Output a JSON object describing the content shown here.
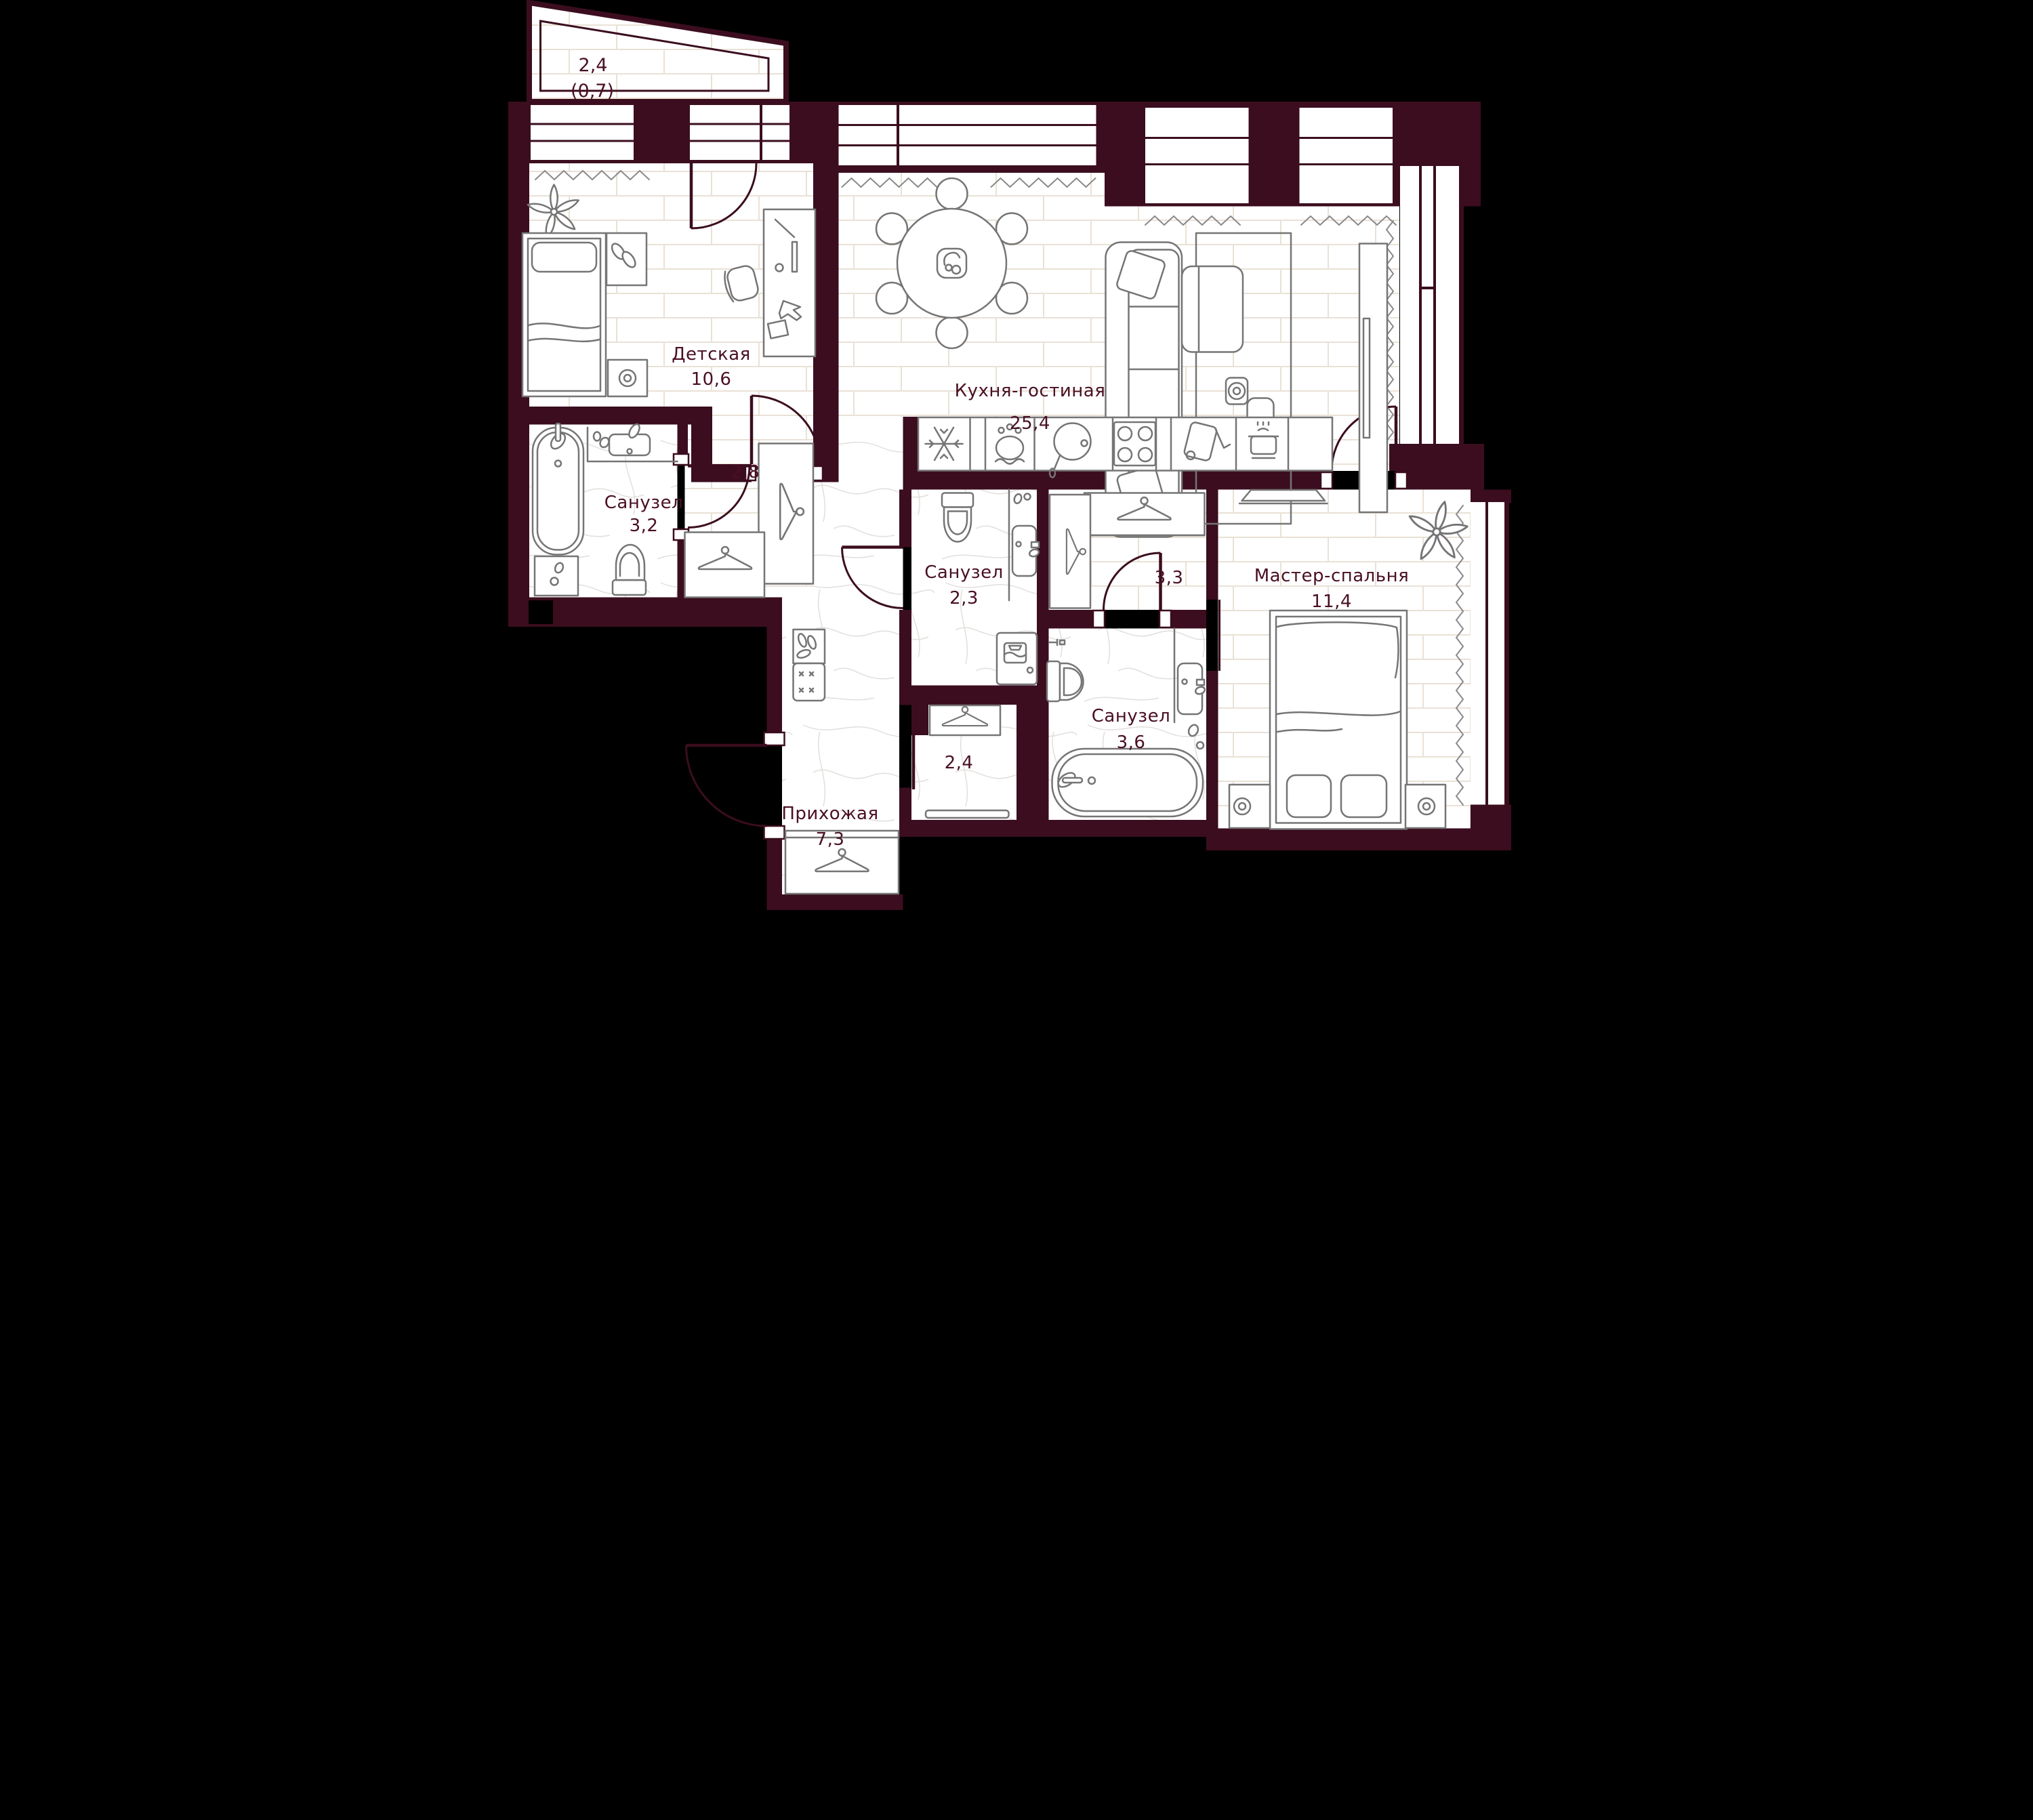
{
  "colors": {
    "background": "#000000",
    "wall": "#3B0D1F",
    "label_text": "#4A0F24",
    "furniture_line": "#757575",
    "floor": "#FFFFFF",
    "plank_line": "#E9E1D6",
    "marble_vein": "#E2DFDB"
  },
  "rooms": [
    {
      "id": "balcony",
      "name": "",
      "area": "2,4",
      "area_reduced": "(0,7)"
    },
    {
      "id": "detskaya",
      "name": "Детская",
      "area": "10,6"
    },
    {
      "id": "kitchen_living",
      "name": "Кухня-гостиная",
      "area": "25,4"
    },
    {
      "id": "bathroom_left",
      "name": "Санузел",
      "area": "3,2"
    },
    {
      "id": "hall_closet",
      "name": "",
      "area": "2,8"
    },
    {
      "id": "bathroom_middle",
      "name": "Санузел",
      "area": "2,3"
    },
    {
      "id": "wardrobe_hall",
      "name": "",
      "area": "3,3"
    },
    {
      "id": "master_bedroom",
      "name": "Мастер-спальня",
      "area": "11,4"
    },
    {
      "id": "bathroom_master",
      "name": "Санузел",
      "area": "3,6"
    },
    {
      "id": "storage_room",
      "name": "",
      "area": "2,4"
    },
    {
      "id": "hallway",
      "name": "Прихожая",
      "area": "7,3"
    }
  ]
}
